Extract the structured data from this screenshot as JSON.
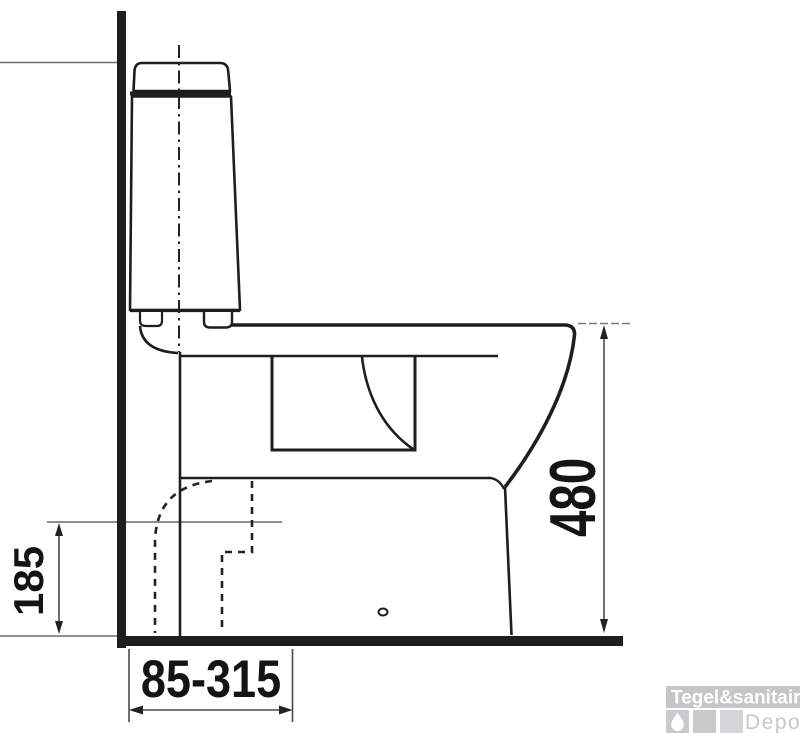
{
  "title": "Toilet side-view installation drawing",
  "drawing": {
    "type": "technical-dimension-drawing",
    "subject": "close-coupled toilet, side profile against wall",
    "dimensions": [
      {
        "id": "trap_height",
        "label": "185",
        "orientation": "vertical-left",
        "meaning": "height of outlet centerline above floor"
      },
      {
        "id": "total_height",
        "label": "480",
        "orientation": "vertical-right",
        "meaning": "height of bowl rim above floor"
      },
      {
        "id": "outlet_range",
        "label": "85-315",
        "orientation": "horizontal-bottom",
        "meaning": "adjustable wall-to-outlet distance range"
      }
    ]
  },
  "dimensions": {
    "trap_height_label": "185",
    "total_height_label": "480",
    "outlet_range_label": "85-315"
  },
  "logo": {
    "brand": "Tegel&sanitair",
    "sub": "Depot",
    "bar_color": "#c5c6c8",
    "square_color": "#c9cacc",
    "brand_text_color": "#ffffff",
    "sub_text_color": "#c6c7c9"
  },
  "colors": {
    "background": "#ffffff",
    "outline": "#1e1e1e",
    "dimension_line": "#4a4a4a",
    "extension_line": "#6a6a6a",
    "text": "#141414"
  },
  "icons": {
    "drop": "water-drop-icon"
  }
}
